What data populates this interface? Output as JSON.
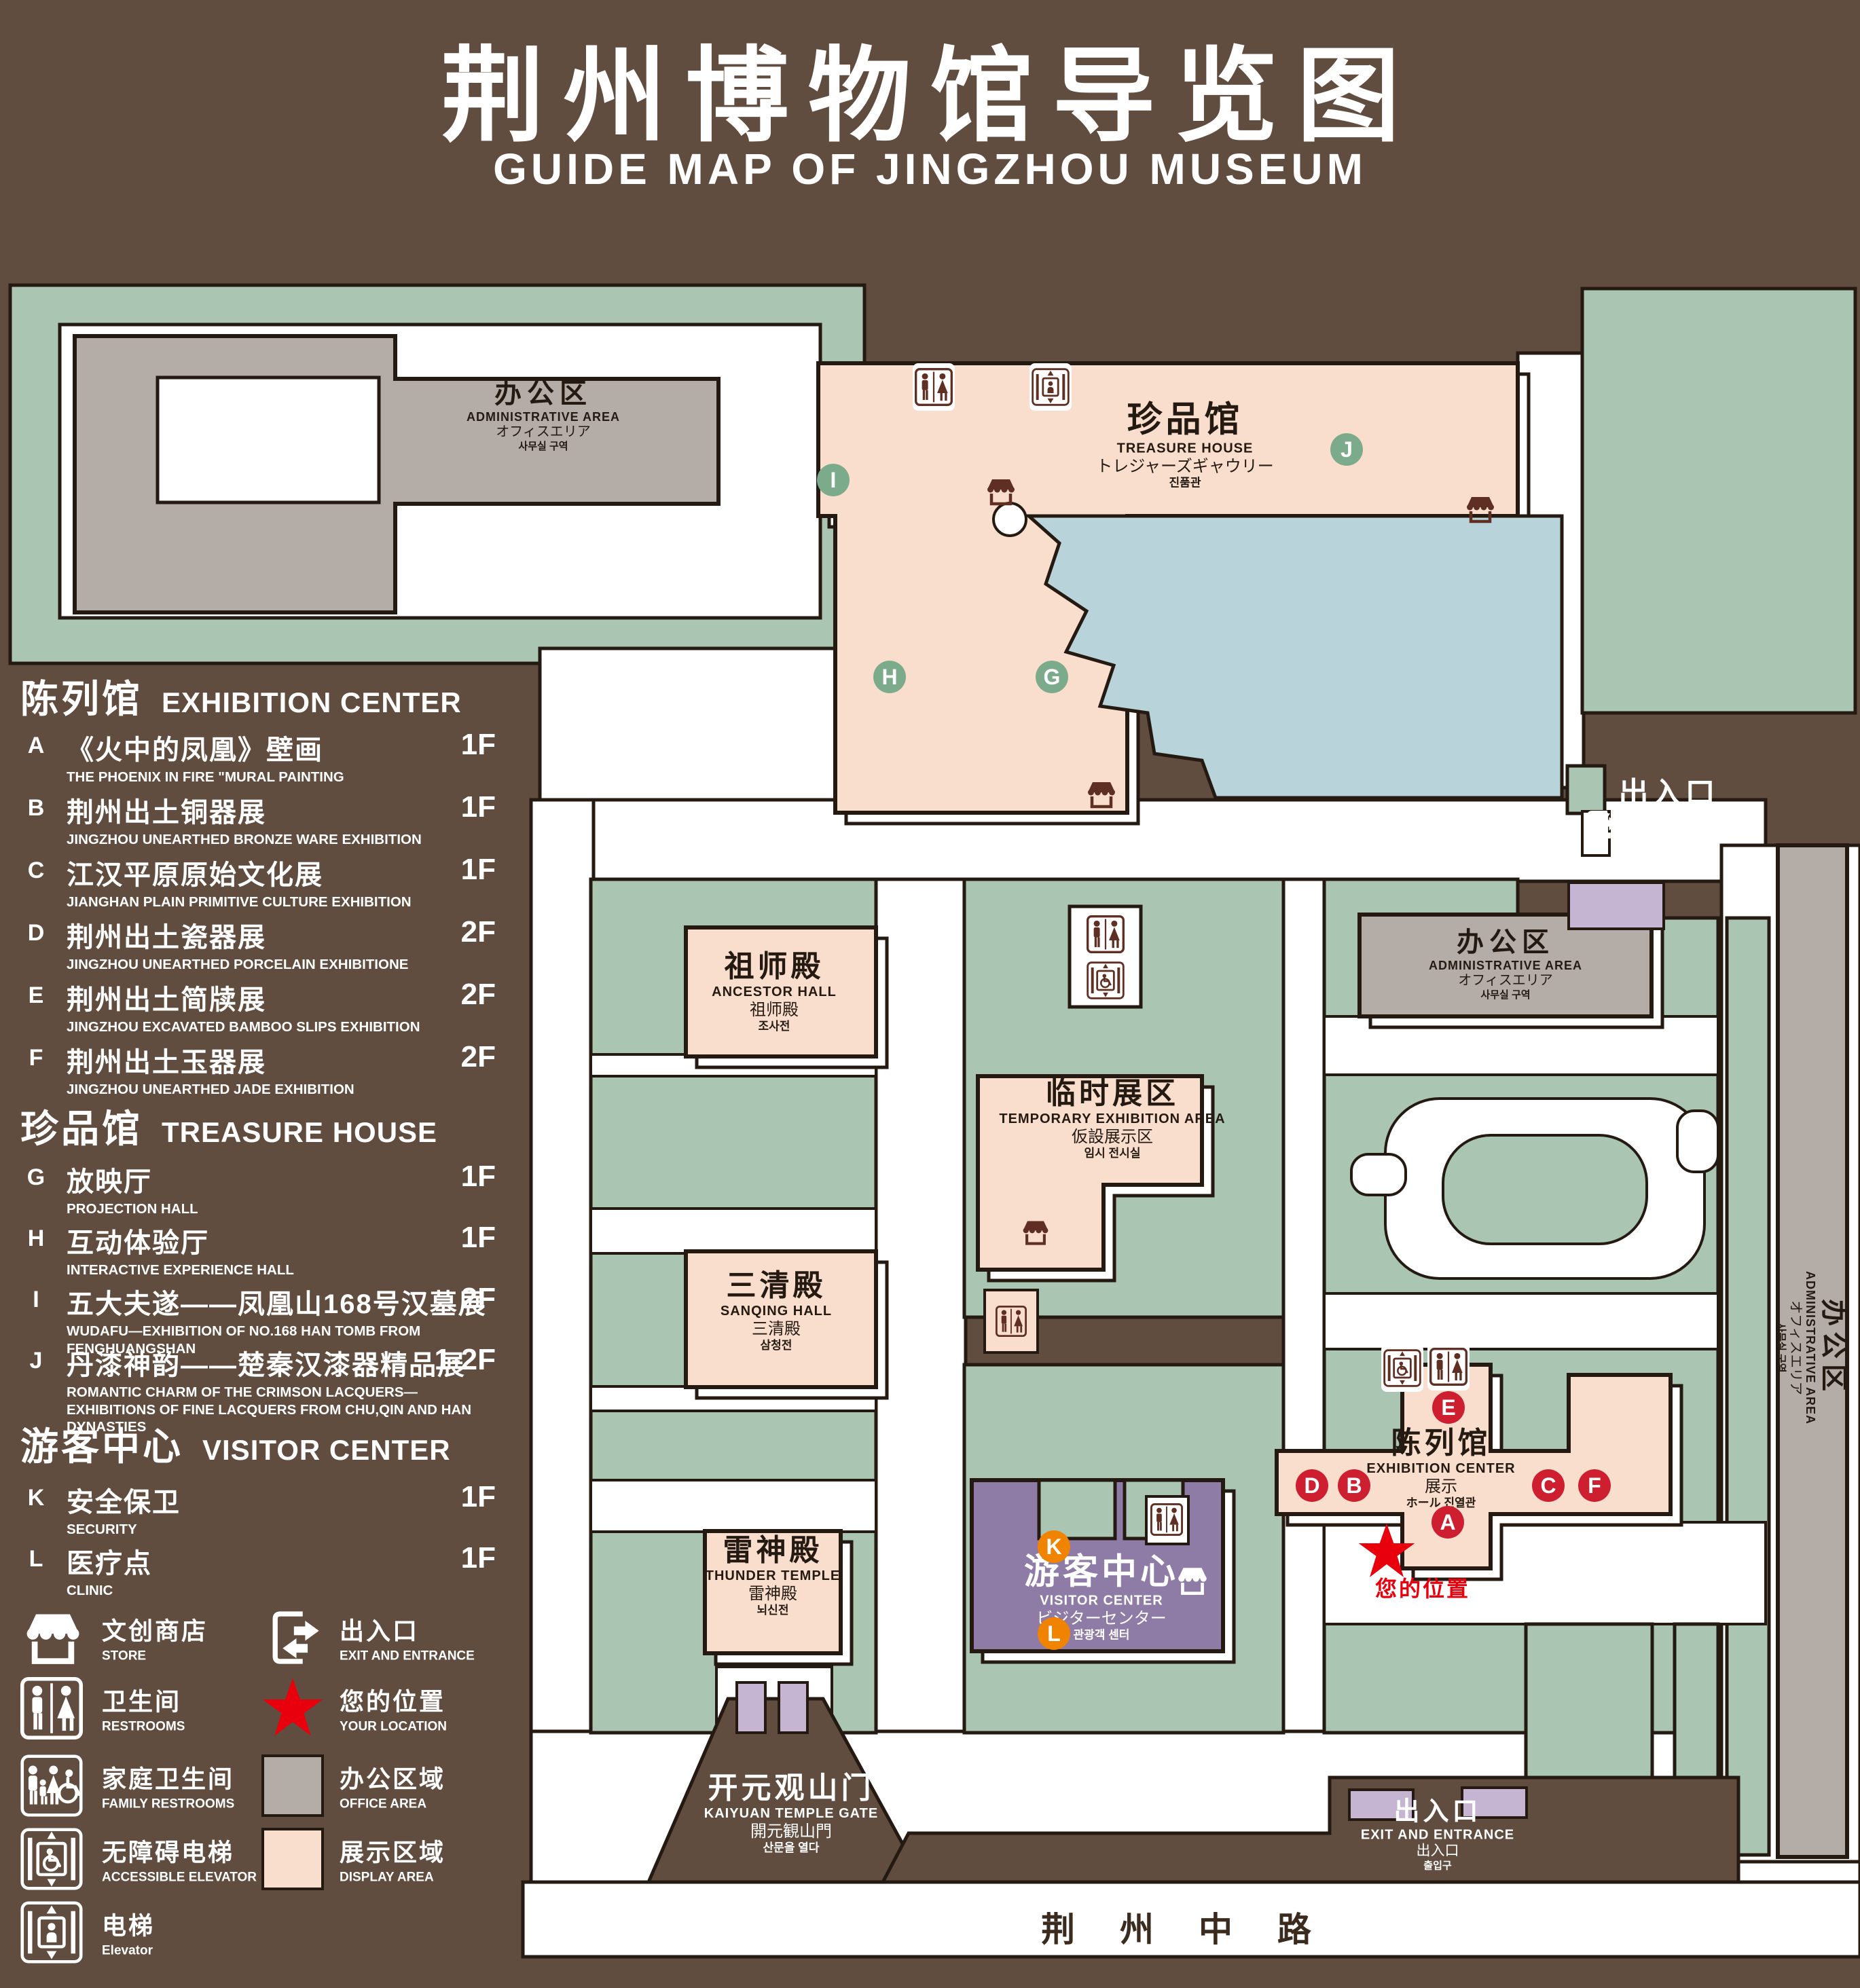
{
  "title": {
    "cn": "荆州博物馆导览图",
    "en": "GUIDE MAP OF JINGZHOU MUSEUM"
  },
  "colors": {
    "background": "#604d3f",
    "green_area": "#aac6b2",
    "display_area_pink": "#f9ddcd",
    "office_area_gray": "#b4ada7",
    "pond_blue": "#b9d3da",
    "visitor_center_purple": "#8e7ba6",
    "gate_light_purple": "#c5b4d2",
    "badge_red": "#cd1f2f",
    "badge_green": "#7cab8c",
    "badge_orange": "#f08300",
    "location_red": "#e8000d",
    "outline_ink": "#241a12",
    "icon_brown": "#5e2f22"
  },
  "legend": {
    "sections": [
      {
        "cn": "陈列馆",
        "en": "EXHIBITION CENTER",
        "badge_color": "red",
        "items": [
          {
            "letter": "A",
            "cn": "《火中的凤凰》壁画",
            "en": "THE PHOENIX IN FIRE \"MURAL PAINTING",
            "floor": "1F"
          },
          {
            "letter": "B",
            "cn": "荆州出土铜器展",
            "en": "JINGZHOU UNEARTHED BRONZE WARE EXHIBITION",
            "floor": "1F"
          },
          {
            "letter": "C",
            "cn": "江汉平原原始文化展",
            "en": "JIANGHAN PLAIN PRIMITIVE CULTURE EXHIBITION",
            "floor": "1F"
          },
          {
            "letter": "D",
            "cn": "荆州出土瓷器展",
            "en": "JINGZHOU UNEARTHED PORCELAIN EXHIBITIONE",
            "floor": "2F"
          },
          {
            "letter": "E",
            "cn": "荆州出土简牍展",
            "en": "JINGZHOU EXCAVATED BAMBOO SLIPS EXHIBITION",
            "floor": "2F"
          },
          {
            "letter": "F",
            "cn": "荆州出土玉器展",
            "en": "JINGZHOU UNEARTHED JADE EXHIBITION",
            "floor": "2F"
          }
        ]
      },
      {
        "cn": "珍品馆",
        "en": "TREASURE HOUSE",
        "badge_color": "grn",
        "items": [
          {
            "letter": "G",
            "cn": "放映厅",
            "en": "PROJECTION HALL",
            "floor": "1F"
          },
          {
            "letter": "H",
            "cn": "互动体验厅",
            "en": "INTERACTIVE EXPERIENCE HALL",
            "floor": "1F"
          },
          {
            "letter": "I",
            "cn": "五大夫遂——凤凰山168号汉墓展",
            "en": "WUDAFU—EXHIBITION OF NO.168 HAN TOMB FROM FENGHUANGSHAN",
            "floor": "2F"
          },
          {
            "letter": "J",
            "cn": "丹漆神韵——楚秦汉漆器精品展",
            "en": "ROMANTIC CHARM OF THE CRIMSON LACQUERS—EXHIBITIONS OF FINE LACQUERS FROM CHU,QIN AND HAN DYNASTIES",
            "floor": "1-2F"
          }
        ]
      },
      {
        "cn": "游客中心",
        "en": "VISITOR CENTER",
        "badge_color": "org",
        "items": [
          {
            "letter": "K",
            "cn": "安全保卫",
            "en": "SECURITY",
            "floor": "1F"
          },
          {
            "letter": "L",
            "cn": "医疗点",
            "en": "CLINIC",
            "floor": "1F"
          }
        ]
      }
    ],
    "symbols": [
      {
        "icon": "store-icon",
        "cn": "文创商店",
        "en": "STORE"
      },
      {
        "icon": "exit-icon",
        "cn": "出入口",
        "en": "EXIT AND ENTRANCE"
      },
      {
        "icon": "restroom-icon",
        "cn": "卫生间",
        "en": "RESTROOMS"
      },
      {
        "icon": "location-star-icon",
        "cn": "您的位置",
        "en": "YOUR LOCATION"
      },
      {
        "icon": "family-restroom-icon",
        "cn": "家庭卫生间",
        "en": "FAMILY RESTROOMS"
      },
      {
        "icon": "office-area-swatch",
        "cn": "办公区域",
        "en": "OFFICE AREA"
      },
      {
        "icon": "accessible-elevator-icon",
        "cn": "无障碍电梯",
        "en": "ACCESSIBLE ELEVATOR"
      },
      {
        "icon": "display-area-swatch",
        "cn": "展示区域",
        "en": "DISPLAY AREA"
      },
      {
        "icon": "elevator-icon",
        "cn": "电梯",
        "en": "Elevator"
      }
    ]
  },
  "map": {
    "labels": {
      "admin_nw": {
        "cn": "办公区",
        "en": "ADMINISTRATIVE AREA",
        "l3": "オフィスエリア",
        "l4": "사무실 구역"
      },
      "treasure": {
        "cn": "珍品馆",
        "en": "TREASURE HOUSE",
        "l3": "トレジャーズギャウリー",
        "l4": "진품관"
      },
      "ancestor": {
        "cn": "祖师殿",
        "en": "ANCESTOR HALL",
        "l3": "祖师殿",
        "l4": "조사전"
      },
      "temporary": {
        "cn": "临时展区",
        "en": "TEMPORARY EXHIBITION AREA",
        "l3": "仮設展示区",
        "l4": "임시 전시실"
      },
      "admin_mid": {
        "cn": "办公区",
        "en": "ADMINISTRATIVE AREA",
        "l3": "オフィスエリア",
        "l4": "사무실 구역"
      },
      "sanqing": {
        "cn": "三清殿",
        "en": "SANQING HALL",
        "l3": "三清殿",
        "l4": "삼청전"
      },
      "thunder": {
        "cn": "雷神殿",
        "en": "THUNDER TEMPLE",
        "l3": "雷神殿",
        "l4": "뇌신전"
      },
      "visitor": {
        "cn": "游客中心",
        "en": "VISITOR CENTER",
        "l3": "ビジターセンター",
        "l4": "관광객 센터"
      },
      "exhibition": {
        "cn": "陈列馆",
        "en": "EXHIBITION CENTER",
        "l3": "展示",
        "l4": "ホール 진열관"
      },
      "exit": {
        "cn": "出入口",
        "en": "EXIT AND ENTRANCE",
        "l3": "出入口",
        "l4": "출입구"
      },
      "kaiyuan": {
        "cn": "开元观山门",
        "en": "KAIYUAN TEMPLE GATE",
        "l3": "開元観山門",
        "l4": "산문을 열다"
      },
      "admin_e": {
        "cn": "办公区",
        "en": "ADMINISTRATIVE AREA",
        "l3": "オフィスエリア",
        "l4": "사무실 구역"
      },
      "your_location": "您的位置",
      "road": "荆 州 中 路"
    },
    "badges": {
      "A": "A",
      "B": "B",
      "C": "C",
      "D": "D",
      "E": "E",
      "F": "F",
      "G": "G",
      "H": "H",
      "I": "I",
      "J": "J",
      "K": "K",
      "L": "L"
    }
  }
}
